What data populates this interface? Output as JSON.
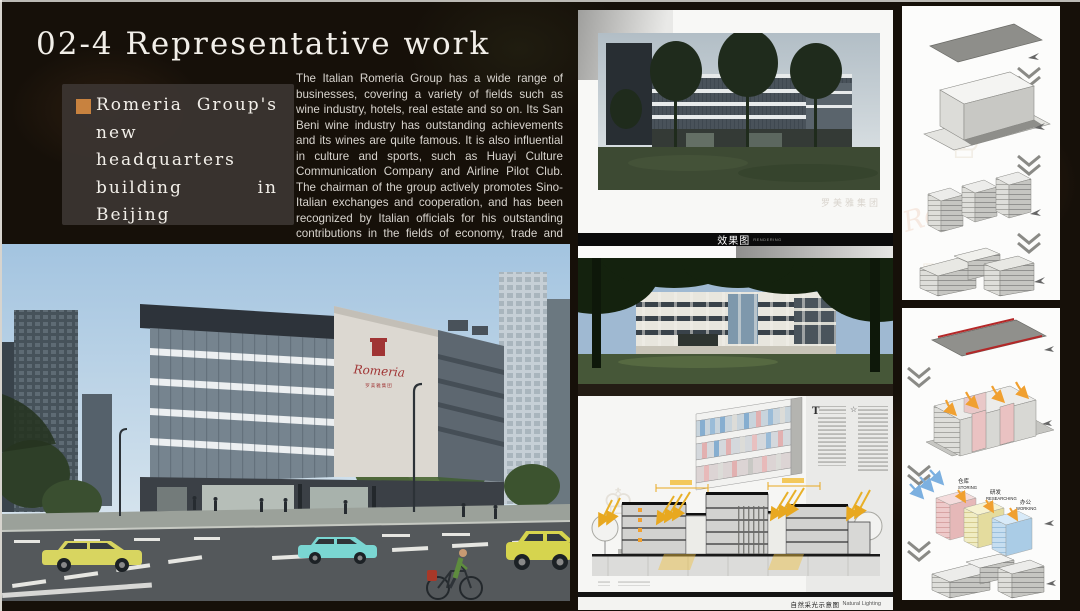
{
  "slide": {
    "title": "02-4 Representative work",
    "bullet": {
      "label": "Romeria Group's new headquarters building in Beijing"
    },
    "description": "The Italian Romeria Group has a wide range of businesses, covering a variety of fields such as wine industry, hotels, real estate and so on. Its San Beni wine industry has outstanding achievements and its wines are quite famous. It is also influential in culture and sports, such as Huayi Culture Communication Company and Airline Pilot Club. The chairman of the group actively promotes Sino-Italian exchanges and cooperation, and has been recognized by Italian officials for his outstanding contributions in the fields of economy, trade and culture."
  },
  "brand": {
    "script": "Romeria",
    "chinese": "罗美雅集团",
    "crest_red": "#a03434",
    "accent_orange": "#c8823f"
  },
  "middle_column": {
    "rendering_bar": {
      "zh": "效果图",
      "en": "RENDERING"
    },
    "lighting_caption": {
      "zh": "自然采光示意图",
      "en": "Natural Lighting"
    },
    "booklet": {
      "dropcap": "T"
    }
  },
  "right_column": {
    "zones": [
      {
        "zh": "仓库",
        "en": "STORING",
        "color": "#f0d4d4"
      },
      {
        "zh": "研发",
        "en": "RESEARCHING",
        "color": "#f2eec4"
      },
      {
        "zh": "办公",
        "en": "WORKING",
        "color": "#c4def2"
      }
    ]
  },
  "icons": {
    "crown": "♔",
    "star": "☆"
  },
  "colors": {
    "background": "#161009",
    "panel_box": "#3b3531",
    "text_light": "#f2efe9"
  }
}
